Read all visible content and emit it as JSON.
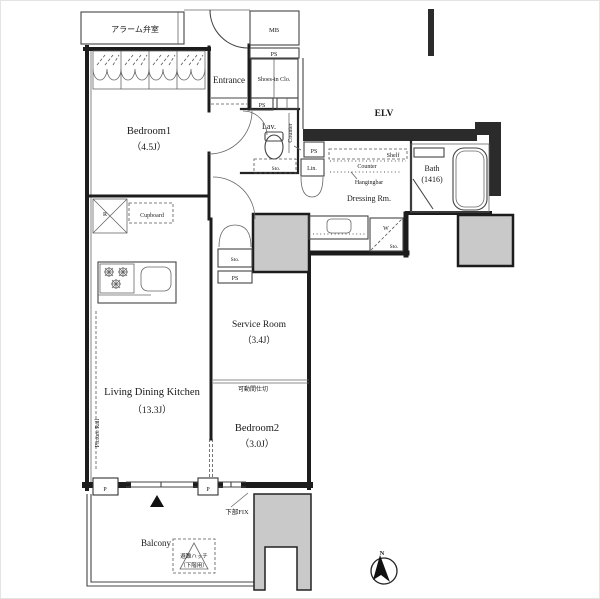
{
  "title": "apartment-floor-plan",
  "colors": {
    "wall": "#1c1c1c",
    "pillar_gray": "#c9c9c9",
    "background": "#ffffff",
    "line": "#444444"
  },
  "labels": {
    "alarm_room": "アラーム弁室",
    "mb": "MB",
    "ps": "PS",
    "entrance": "Entrance",
    "shoes_closet": "Shoes-in Clo.",
    "elv": "ELV",
    "bedroom1_name": "Bedroom1",
    "bedroom1_size": "（4.5J）",
    "lavatory": "Lav.",
    "counter": "Counter",
    "sto": "Sto.",
    "lin": "Lin.",
    "shelf": "Shelf",
    "hangingbar": "Hangingbar",
    "dressing_room": "Dressing Rm.",
    "bath_name": "Bath",
    "bath_size": "(1416)",
    "washer": "W",
    "refrigerator": "R",
    "cupboard": "Cupboard",
    "service_room_name": "Service Room",
    "service_room_size": "（3.4J）",
    "movable_partition": "可動間仕切",
    "bedroom2_name": "Bedroom2",
    "bedroom2_size": "（3.0J）",
    "ldk_name": "Living Dining Kitchen",
    "ldk_size": "（13.3J）",
    "picture_rail": "Picture Rail",
    "pipe": "P",
    "balcony": "Balcony",
    "escape_hatch_line1": "避難ハッチ",
    "escape_hatch_line2": "（下階用）",
    "lower_fix": "下部FIX",
    "compass_north": "N"
  }
}
